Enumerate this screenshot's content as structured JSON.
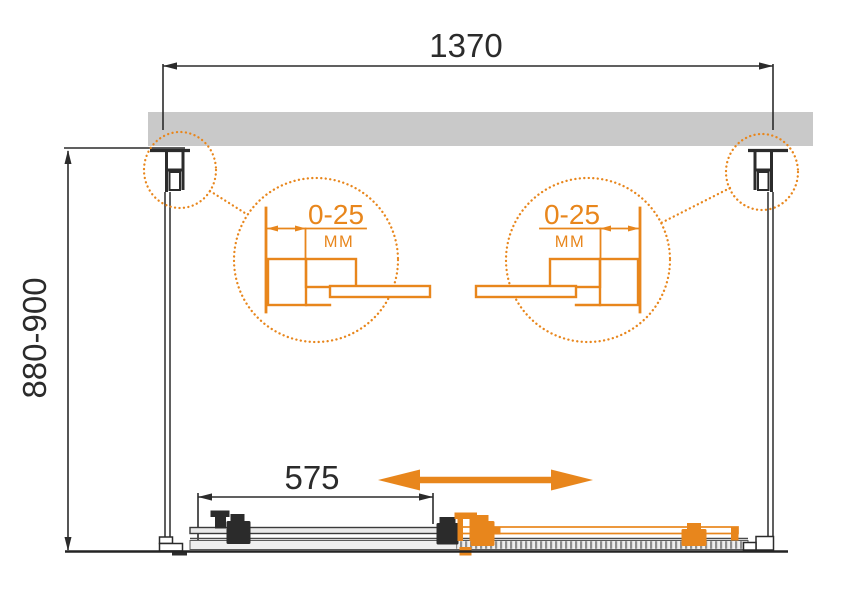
{
  "colors": {
    "accent_orange": "#E8861C",
    "wall_gray": "#C9C9C9",
    "line_ink": "#2B2B2B",
    "rail_gray": "#EFEFEF"
  },
  "dimensions": {
    "overall_width": "1370",
    "overall_height": "880-900",
    "door_panel_width": "575"
  },
  "details": {
    "left": {
      "adjustment_range": "0-25",
      "unit": "MM"
    },
    "right": {
      "adjustment_range": "0-25",
      "unit": "MM"
    }
  }
}
